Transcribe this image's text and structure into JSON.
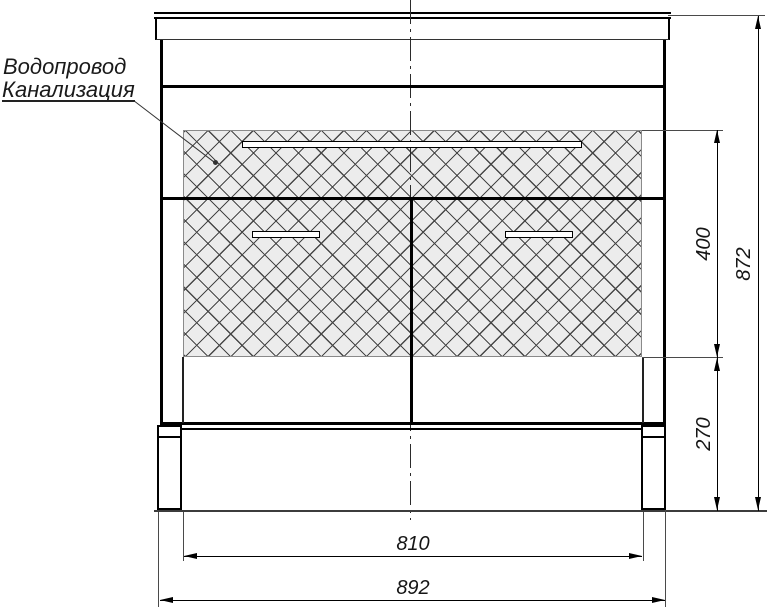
{
  "callout": {
    "line1": "Водопровод",
    "line2": "Канализация"
  },
  "dimensions": {
    "plinth_inner_width": "810",
    "overall_width": "892",
    "service_zone_height": "400",
    "service_zone_floor_offset": "270",
    "overall_height": "872"
  },
  "colors": {
    "line": "#000000",
    "hatch_background": "#ececec",
    "background": "#ffffff"
  }
}
